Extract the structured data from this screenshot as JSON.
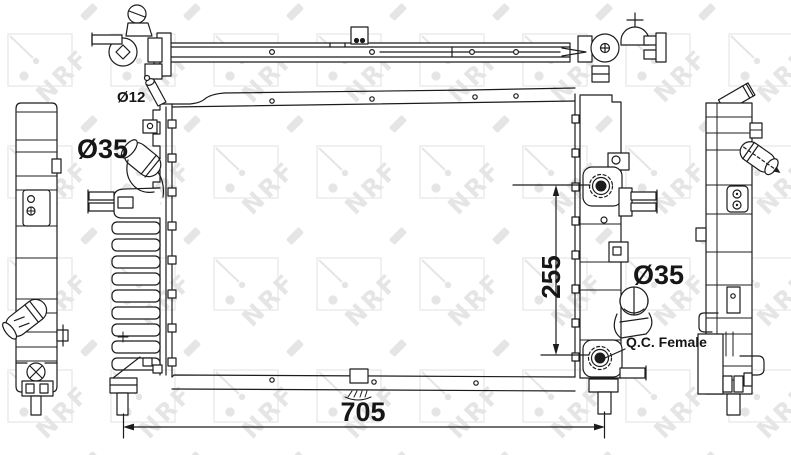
{
  "page": {
    "background_color": "#ffffff",
    "line_color": "#1c1c1c"
  },
  "watermark": {
    "text": "NRF",
    "color": "#e5e5e5",
    "square_color": "#e9e9e9"
  },
  "annotations": {
    "neck_diameter": "Ø12",
    "inlet_diameter": "Ø35",
    "height": "255",
    "outlet_diameter": "Ø35",
    "qc_connector": "Q.C. Female",
    "width": "705"
  }
}
